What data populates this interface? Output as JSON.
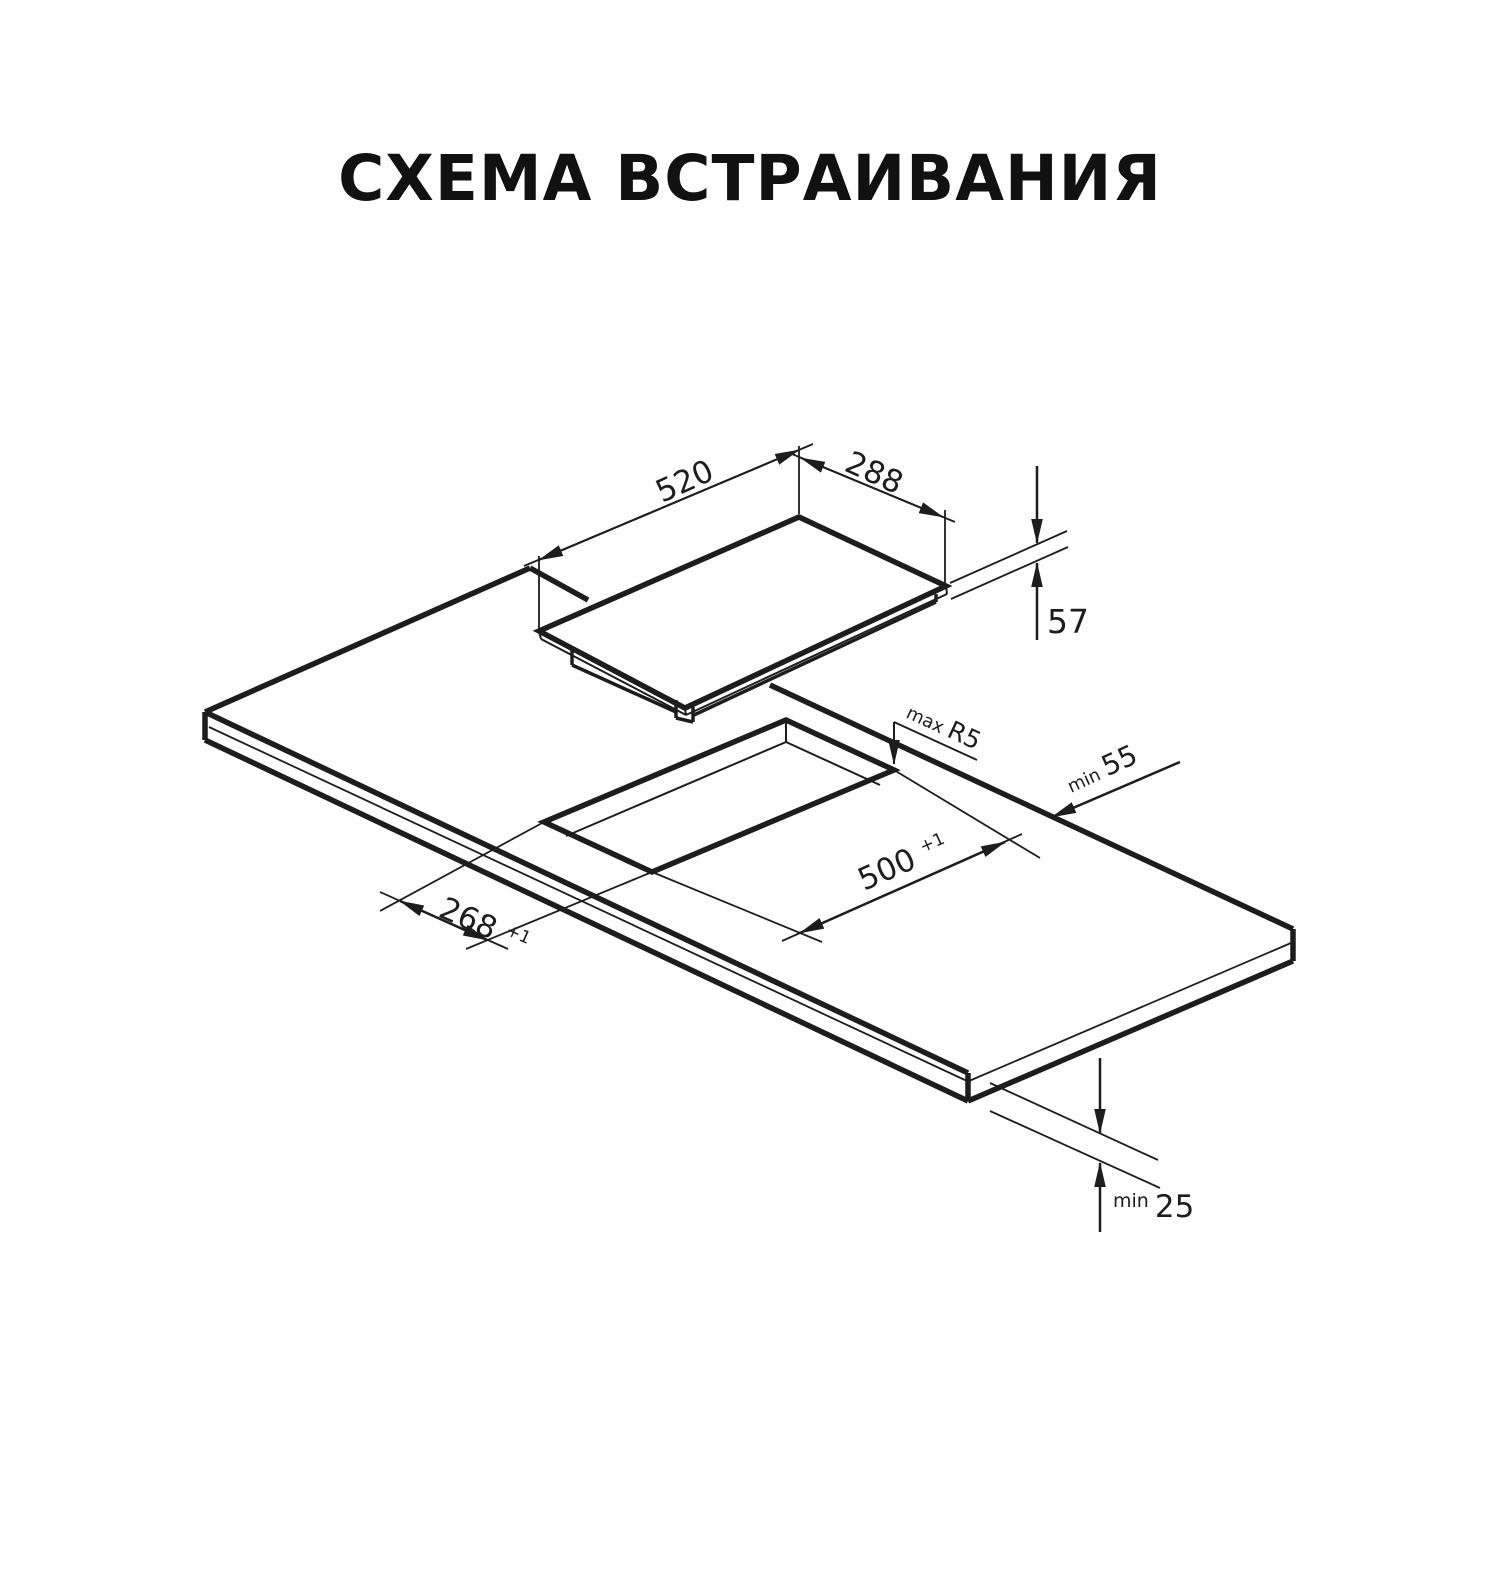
{
  "title": "СХЕМА ВСТРАИВАНИЯ",
  "line_color": "#1d1d1d",
  "diagram": {
    "hob": {
      "width": {
        "value": "520"
      },
      "depth": {
        "value": "288"
      },
      "height": {
        "value": "57"
      }
    },
    "cutout": {
      "corner_radius": {
        "prefix": "max ",
        "value": "R5"
      },
      "edge_clearance": {
        "prefix": "min ",
        "value": "55"
      },
      "length": {
        "value": "500",
        "tolerance": "+1"
      },
      "width": {
        "value": "268",
        "tolerance": "+1"
      },
      "worktop_thickness": {
        "prefix": "min ",
        "value": "25"
      }
    }
  }
}
